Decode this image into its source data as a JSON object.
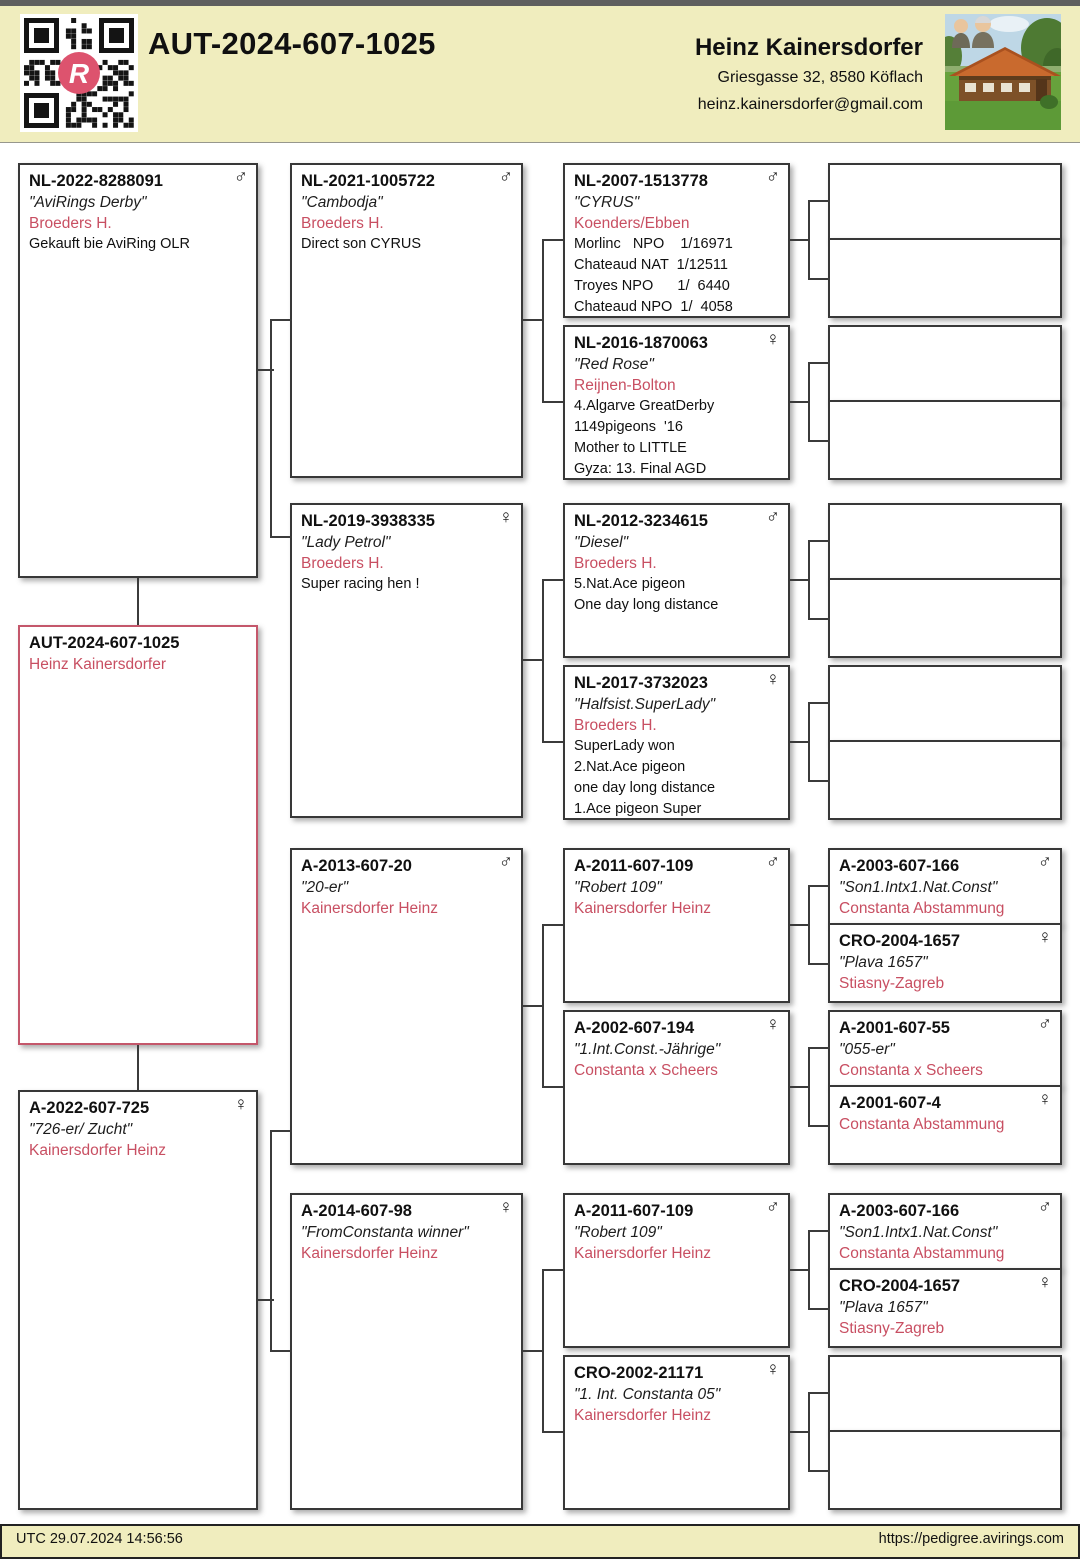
{
  "header": {
    "ring_title": "AUT-2024-607-1025",
    "qr_logo_letter": "R",
    "owner": {
      "name": "Heinz Kainersdorfer",
      "address": "Griesgasse 32, 8580 Köflach",
      "email": "heinz.kainersdorfer@gmail.com"
    }
  },
  "footer": {
    "timestamp_utc": "UTC 29.07.2024 14:56:56",
    "website": "https://pedigree.avirings.com"
  },
  "colors": {
    "band_background": "#f0edbe",
    "accent_pink_text": "#c84f62",
    "subject_border_pink": "#c4576b",
    "qr_logo_pink": "#dd536e",
    "line_dark": "#3b3b3b"
  },
  "symbols": {
    "male": "♂",
    "female": "♀"
  },
  "pedigree": {
    "subject": {
      "ring": "AUT-2024-607-1025",
      "breeder": "Heinz Kainersdorfer"
    },
    "father": {
      "ring": "NL-2022-8288091",
      "sex": "♂",
      "name": "\"AviRings Derby\"",
      "breeder": "Broeders H.",
      "line1": "Gekauft bie AviRing OLR"
    },
    "mother": {
      "ring": "A-2022-607-725",
      "sex": "♀",
      "name": "\"726-er/ Zucht\"",
      "breeder": "Kainersdorfer Heinz"
    },
    "pgf": {
      "ring": "NL-2021-1005722",
      "sex": "♂",
      "name": "\"Cambodja\"",
      "breeder": "Broeders H.",
      "line1": "Direct son CYRUS"
    },
    "pgm": {
      "ring": "NL-2019-3938335",
      "sex": "♀",
      "name": "\"Lady Petrol\"",
      "breeder": "Broeders H.",
      "line1": "Super racing hen !"
    },
    "mgf": {
      "ring": "A-2013-607-20",
      "sex": "♂",
      "name": "\"20-er\"",
      "breeder": "Kainersdorfer Heinz"
    },
    "mgm": {
      "ring": "A-2014-607-98",
      "sex": "♀",
      "name": "\"FromConstanta winner\"",
      "breeder": "Kainersdorfer Heinz"
    },
    "pgf_f": {
      "ring": "NL-2007-1513778",
      "sex": "♂",
      "name": "\"CYRUS\"",
      "breeder": "Koenders/Ebben",
      "line1": "Morlinc   NPO    1/16971",
      "line2": "Chateaud NAT  1/12511",
      "line3": "Troyes NPO      1/  6440",
      "line4": "Chateaud NPO  1/  4058"
    },
    "pgf_m": {
      "ring": "NL-2016-1870063",
      "sex": "♀",
      "name": "\"Red Rose\"",
      "breeder": "Reijnen-Bolton",
      "line1": "4.Algarve GreatDerby",
      "line2": "1149pigeons  '16",
      "line3": "Mother to LITTLE",
      "line4": "Gyza: 13. Final AGD"
    },
    "pgm_f": {
      "ring": "NL-2012-3234615",
      "sex": "♂",
      "name": "\"Diesel\"",
      "breeder": "Broeders H.",
      "line1": "5.Nat.Ace pigeon",
      "line2": "One day long distance"
    },
    "pgm_m": {
      "ring": "NL-2017-3732023",
      "sex": "♀",
      "name": "\"Halfsist.SuperLady\"",
      "breeder": "Broeders H.",
      "line1": "SuperLady won",
      "line2": "2.Nat.Ace pigeon",
      "line3": "one day long distance",
      "line4": "1.Ace pigeon Super"
    },
    "mgf_f": {
      "ring": "A-2011-607-109",
      "sex": "♂",
      "name": "\"Robert 109\"",
      "breeder": "Kainersdorfer Heinz"
    },
    "mgf_m": {
      "ring": "A-2002-607-194",
      "sex": "♀",
      "name": "\"1.Int.Const.-Jährige\"",
      "breeder": "Constanta x Scheers"
    },
    "mgm_f": {
      "ring": "A-2011-607-109",
      "sex": "♂",
      "name": "\"Robert 109\"",
      "breeder": "Kainersdorfer Heinz"
    },
    "mgm_m": {
      "ring": "CRO-2002-21171",
      "sex": "♀",
      "name": "\"1. Int. Constanta 05\"",
      "breeder": "Kainersdorfer Heinz"
    },
    "g5_mgf_f_f": {
      "ring": "A-2003-607-166",
      "sex": "♂",
      "name": "\"Son1.Intx1.Nat.Const\"",
      "breeder": "Constanta Abstammung"
    },
    "g5_mgf_f_m": {
      "ring": "CRO-2004-1657",
      "sex": "♀",
      "name": "\"Plava 1657\"",
      "breeder": "Stiasny-Zagreb"
    },
    "g5_mgf_m_f": {
      "ring": "A-2001-607-55",
      "sex": "♂",
      "name": "\"055-er\"",
      "breeder": "Constanta x Scheers"
    },
    "g5_mgf_m_m": {
      "ring": "A-2001-607-4",
      "sex": "♀",
      "breeder": "Constanta Abstammung"
    },
    "g5_mgm_f_f": {
      "ring": "A-2003-607-166",
      "sex": "♂",
      "name": "\"Son1.Intx1.Nat.Const\"",
      "breeder": "Constanta Abstammung"
    },
    "g5_mgm_f_m": {
      "ring": "CRO-2004-1657",
      "sex": "♀",
      "name": "\"Plava 1657\"",
      "breeder": "Stiasny-Zagreb"
    }
  }
}
